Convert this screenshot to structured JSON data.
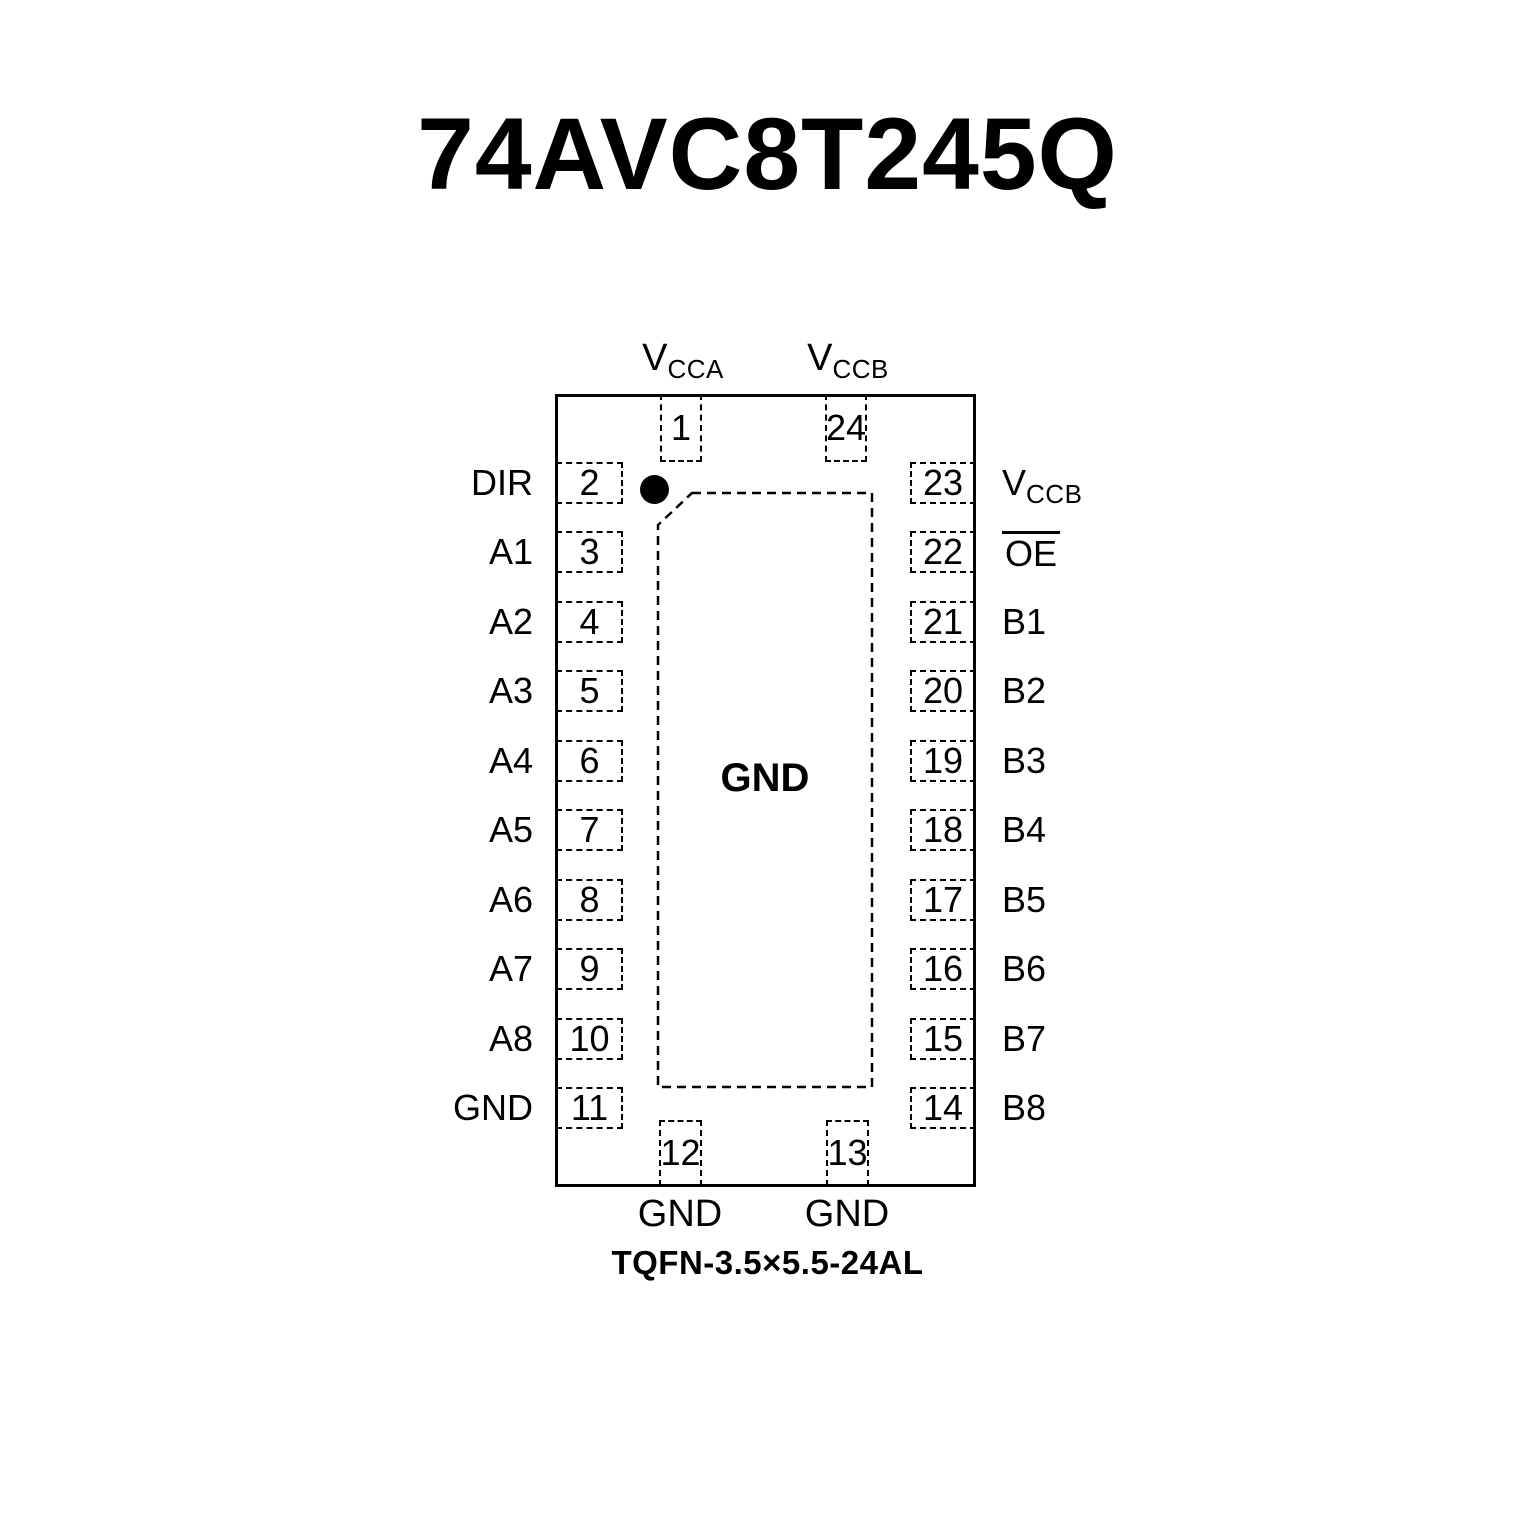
{
  "title": "74AVC8T245Q",
  "package_label": "TQFN-3.5×5.5-24AL",
  "colors": {
    "ink": "#000000",
    "background": "#ffffff"
  },
  "chip": {
    "center_pad_label": "GND",
    "pin1_indicator": "filled-circle"
  },
  "pins": {
    "top": [
      {
        "number": "1",
        "label_main": "V",
        "label_sub": "CCA"
      },
      {
        "number": "24",
        "label_main": "V",
        "label_sub": "CCB"
      }
    ],
    "left": [
      {
        "number": "2",
        "label": "DIR"
      },
      {
        "number": "3",
        "label": "A1"
      },
      {
        "number": "4",
        "label": "A2"
      },
      {
        "number": "5",
        "label": "A3"
      },
      {
        "number": "6",
        "label": "A4"
      },
      {
        "number": "7",
        "label": "A5"
      },
      {
        "number": "8",
        "label": "A6"
      },
      {
        "number": "9",
        "label": "A7"
      },
      {
        "number": "10",
        "label": "A8"
      },
      {
        "number": "11",
        "label": "GND"
      }
    ],
    "right": [
      {
        "number": "23",
        "label_main": "V",
        "label_sub": "CCB"
      },
      {
        "number": "22",
        "label": "OE",
        "overline": true
      },
      {
        "number": "21",
        "label": "B1"
      },
      {
        "number": "20",
        "label": "B2"
      },
      {
        "number": "19",
        "label": "B3"
      },
      {
        "number": "18",
        "label": "B4"
      },
      {
        "number": "17",
        "label": "B5"
      },
      {
        "number": "16",
        "label": "B6"
      },
      {
        "number": "15",
        "label": "B7"
      },
      {
        "number": "14",
        "label": "B8"
      }
    ],
    "bottom": [
      {
        "number": "12",
        "label": "GND"
      },
      {
        "number": "13",
        "label": "GND"
      }
    ]
  }
}
